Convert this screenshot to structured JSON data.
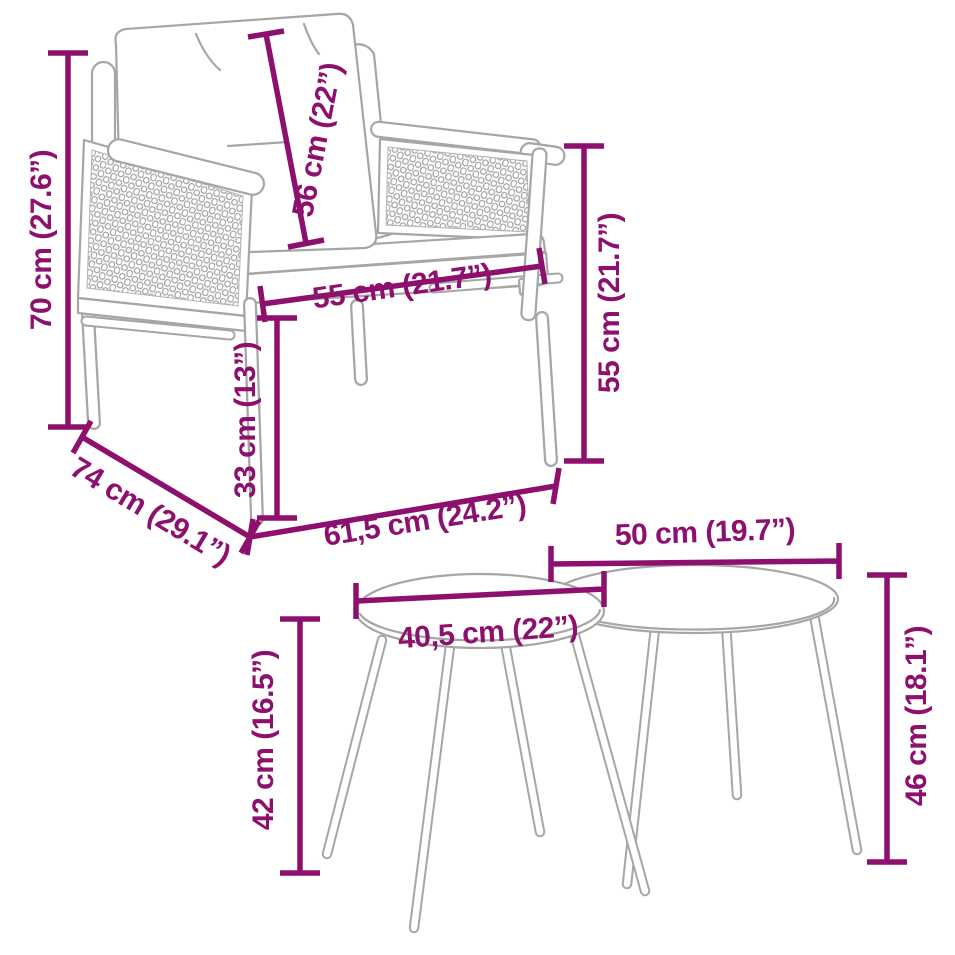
{
  "diagram": {
    "kind": "product-dimension-diagram",
    "subject": "garden chair with cushions and two nesting side tables"
  },
  "style": {
    "dimension_color": "#8E106E",
    "line_color": "#A6A6A6",
    "background": "#FFFFFF"
  },
  "chair": {
    "height_label": "70 cm (27.6”)",
    "cushion_height_label": "56 cm (22”)",
    "seat_width_label": "55 cm (21.7”)",
    "back_height_label": "55 cm (21.7”)",
    "leg_height_label": "33 cm (13”)",
    "depth_label": "74 cm (29.1”)",
    "width_label": "61,5 cm (24.2”)"
  },
  "tables": {
    "small": {
      "diameter_label": "40,5 cm (22”)",
      "height_label": "42 cm (16.5”)"
    },
    "large": {
      "diameter_label": "50 cm (19.7”)",
      "height_label": "46 cm (18.1”)"
    }
  }
}
